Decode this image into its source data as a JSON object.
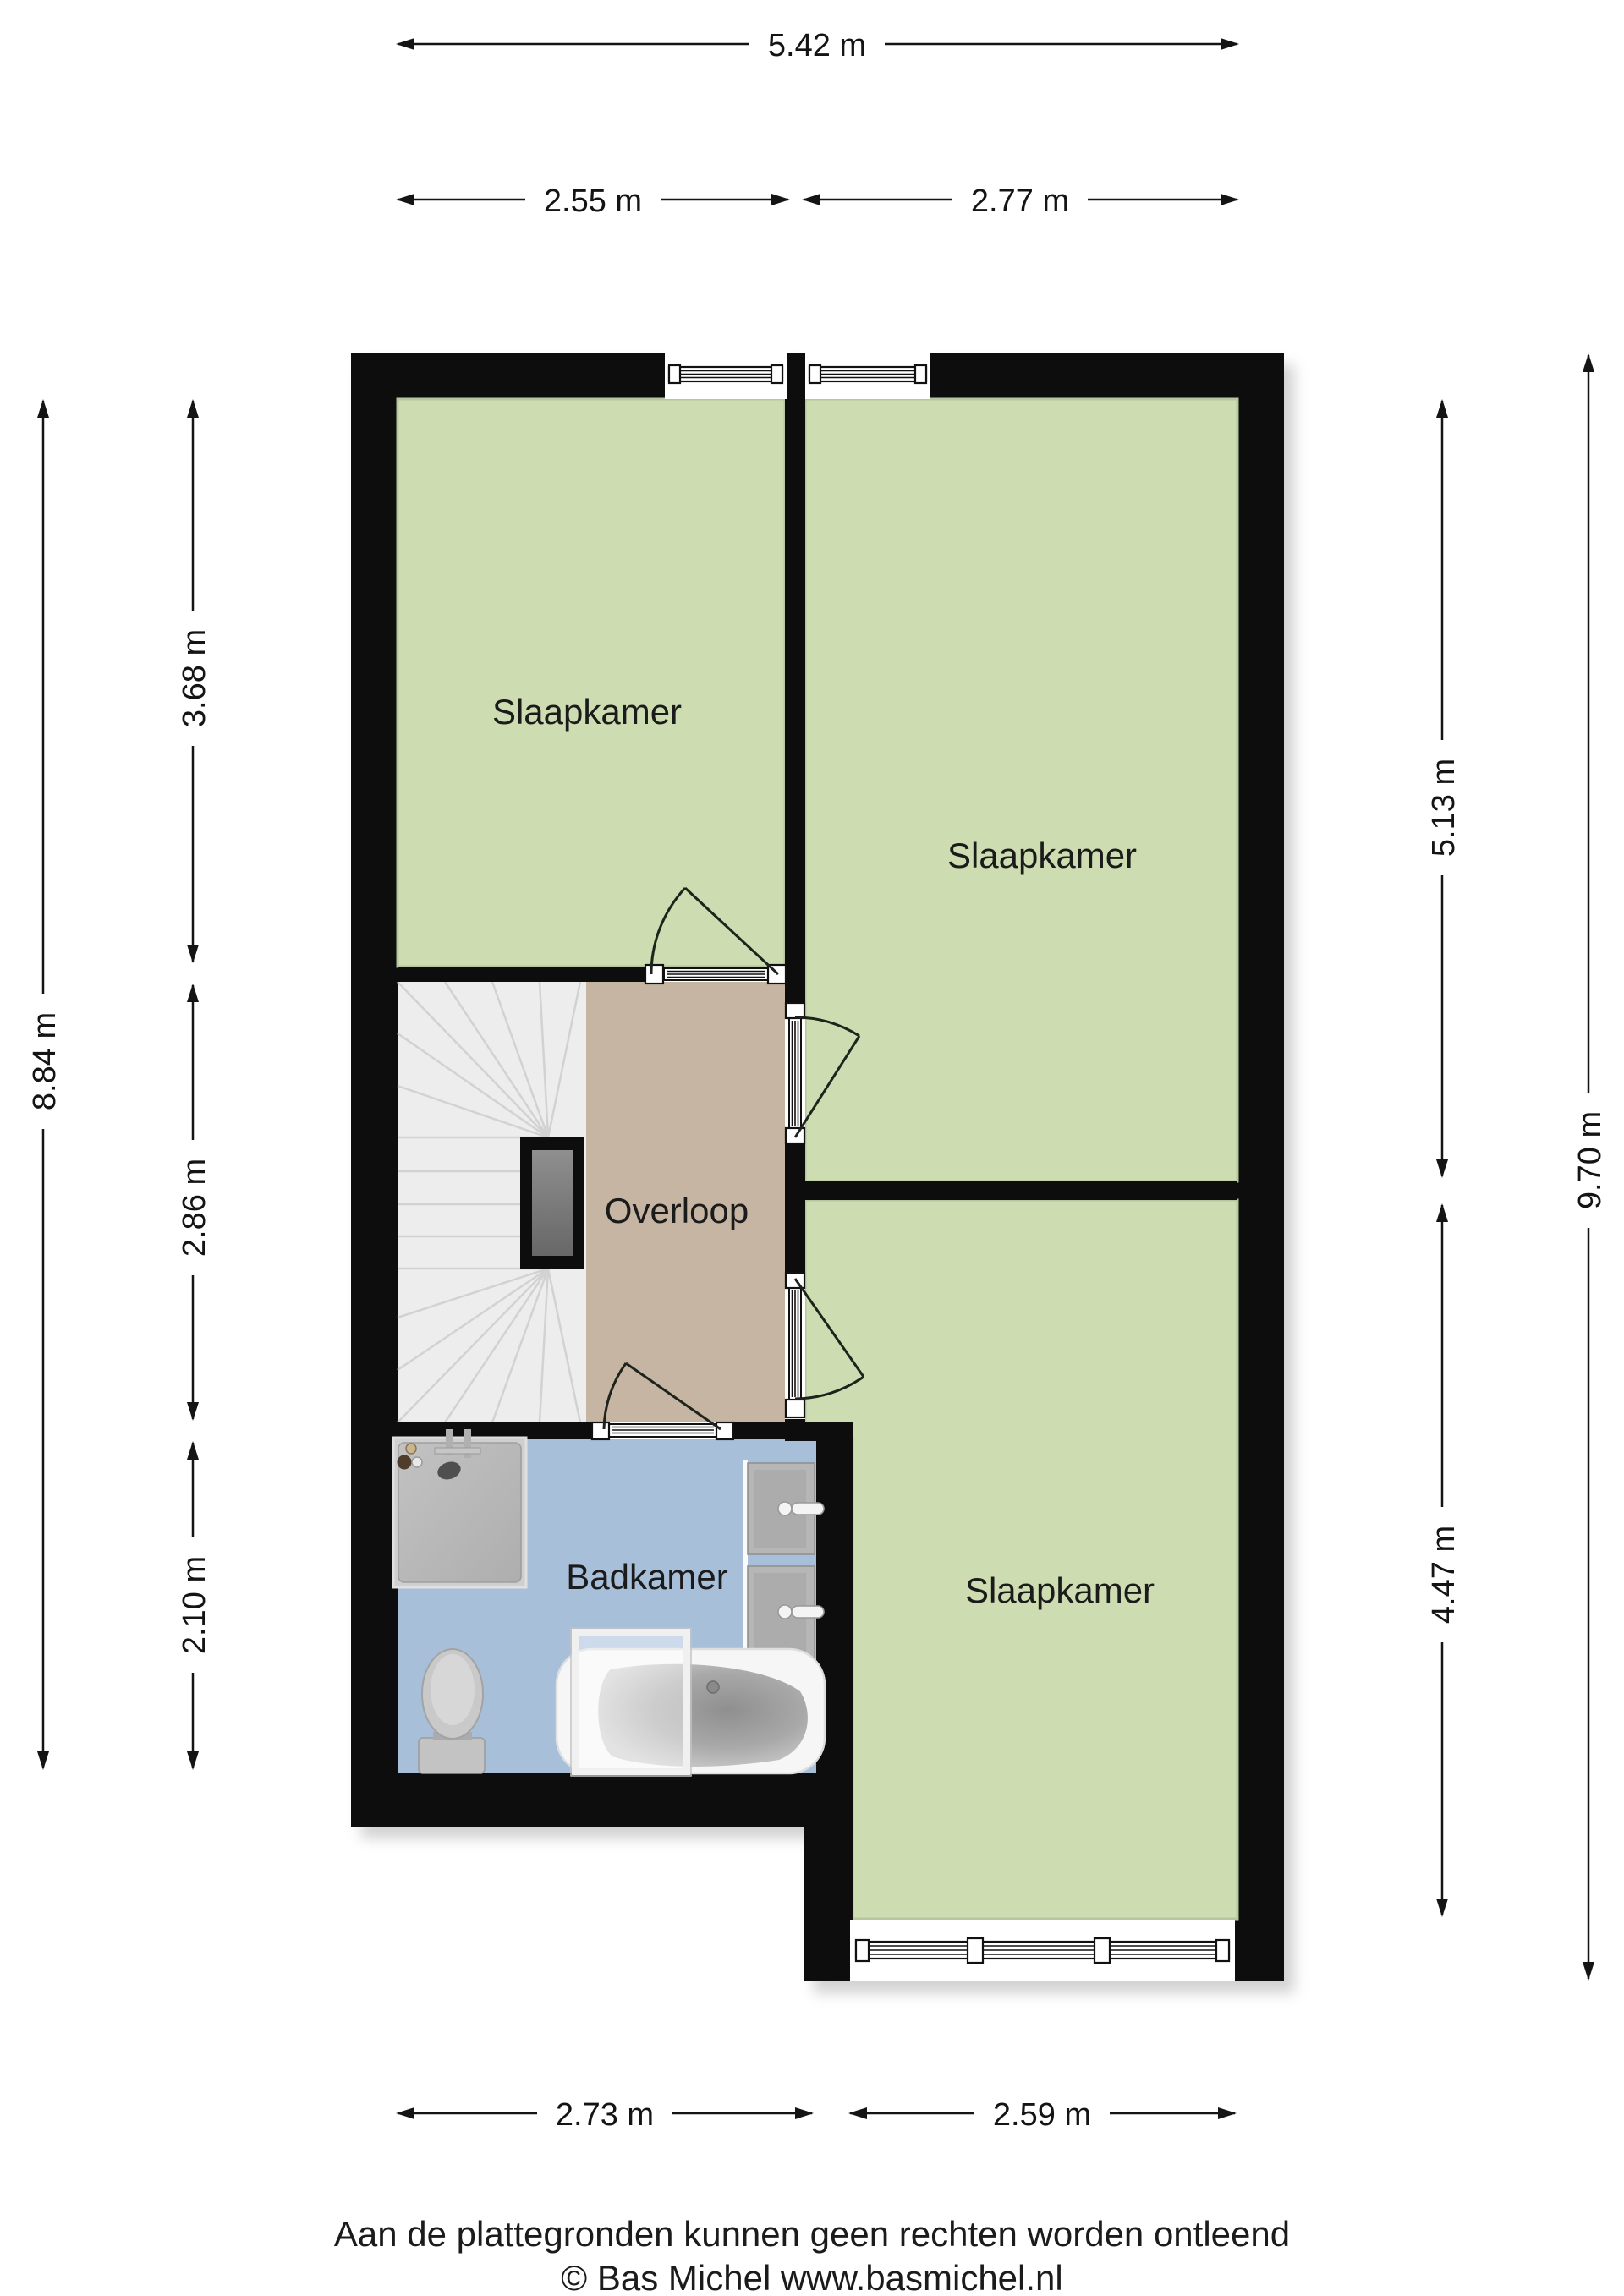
{
  "plan": {
    "floor_name": "Verdieping (floor plan)",
    "rooms": {
      "bedroom_top_left": "Slaapkamer",
      "bedroom_top_right": "Slaapkamer",
      "bedroom_bottom": "Slaapkamer",
      "landing": "Overloop",
      "bathroom": "Badkamer"
    }
  },
  "dimensions": {
    "top_total": "5.42 m",
    "top_left": "2.55 m",
    "top_right": "2.77 m",
    "left_total": "8.84 m",
    "left_top": "3.68 m",
    "left_middle": "2.86 m",
    "left_bottom": "2.10 m",
    "right_top": "5.13 m",
    "right_bottom": "4.47 m",
    "right_total": "9.70 m",
    "bottom_left": "2.73 m",
    "bottom_right": "2.59 m"
  },
  "footer": {
    "disclaimer": "Aan de plattegronden kunnen geen rechten worden ontleend",
    "copyright": "© Bas Michel www.basmichel.nl"
  },
  "colors": {
    "wall_black": "#0d0d0d",
    "room_green": "#cdddb1",
    "landing_tan": "#c6b5a3",
    "bathroom_blue": "#a8bfda",
    "stairs_grey": "#ededed"
  }
}
